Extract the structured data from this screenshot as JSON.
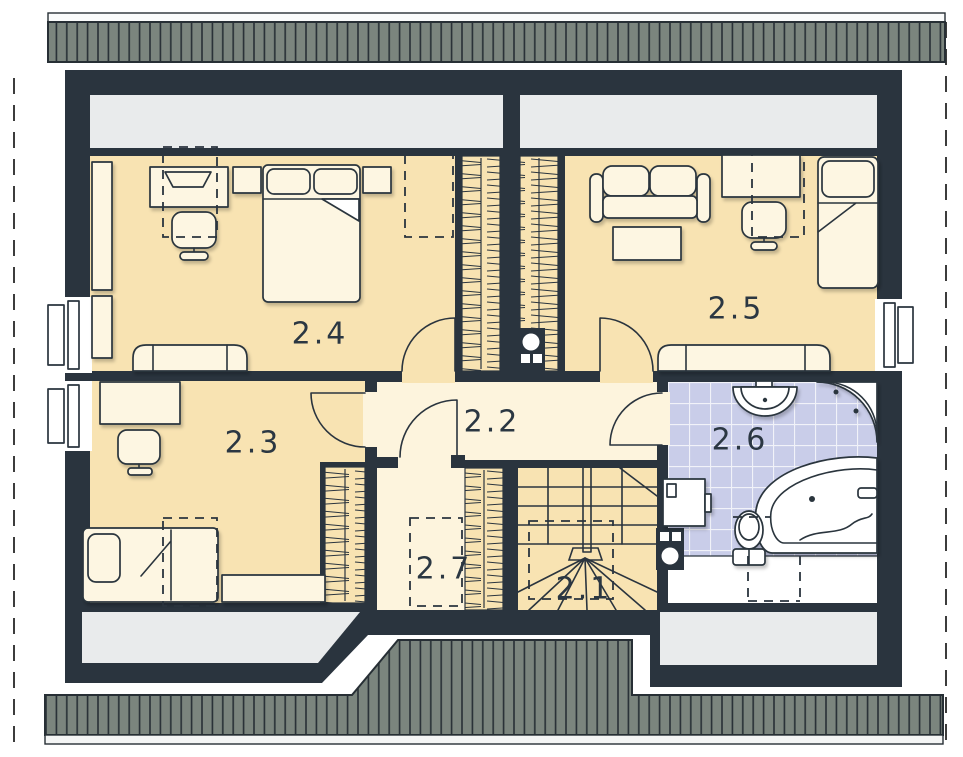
{
  "plan": {
    "title": "attic floor plan",
    "rooms": [
      {
        "id": "room-2-1",
        "label": "2.1"
      },
      {
        "id": "room-2-2",
        "label": "2.2"
      },
      {
        "id": "room-2-3",
        "label": "2.3"
      },
      {
        "id": "room-2-4",
        "label": "2.4"
      },
      {
        "id": "room-2-5",
        "label": "2.5"
      },
      {
        "id": "room-2-6",
        "label": "2.6"
      },
      {
        "id": "room-2-7",
        "label": "2.7"
      }
    ],
    "icons": [
      "double-bed-icon",
      "single-bed-icon",
      "desk-icon",
      "office-chair-icon",
      "sofa-icon",
      "coffee-table-icon",
      "wardrobe-icon",
      "dresser-icon",
      "stairs-icon",
      "chimney-icon",
      "sink-icon",
      "corner-shower-icon",
      "corner-bathtub-icon",
      "toilet-icon",
      "washing-machine-icon",
      "roof-window-icon",
      "door-icon",
      "window-icon",
      "roof-hatch-icon"
    ]
  },
  "palette": {
    "wall": "#2a343e",
    "room_floor": "#f8e3b2",
    "hall_floor": "#fdf4dd",
    "bath_tile": "#c9cde9",
    "furniture": "#fdf6e2",
    "roof_slope": "#e9ebec",
    "roof_band": "#7b857e",
    "roof_band_line": "#272f35",
    "fascia": "#f4f5f5",
    "label_color": "#2b3742",
    "page": "#ffffff",
    "dash_line": "#3c3c3c"
  }
}
